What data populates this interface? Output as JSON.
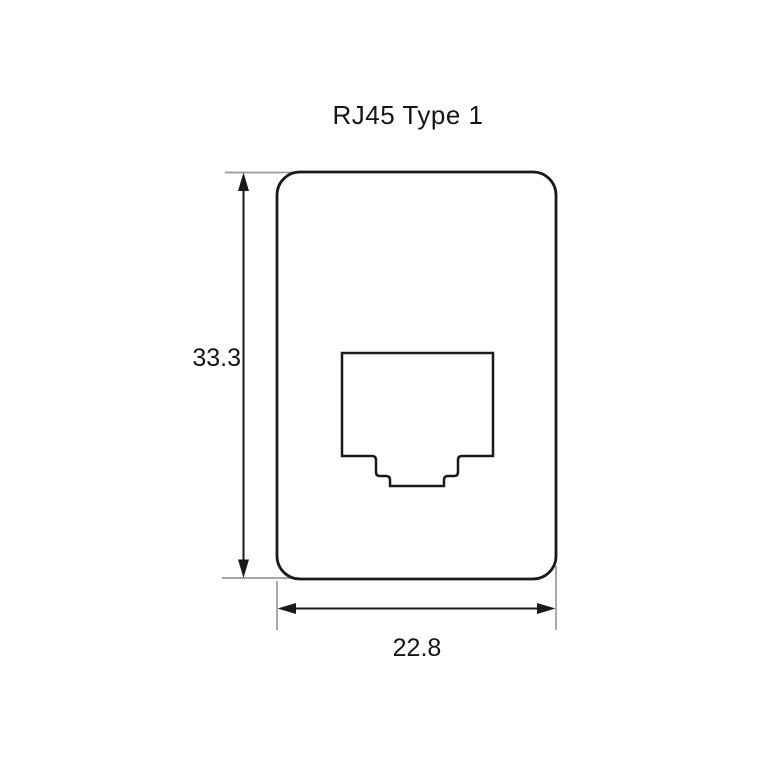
{
  "drawing": {
    "title": "RJ45 Type 1",
    "dimensions": {
      "height_value": "33.3",
      "width_value": "22.8"
    },
    "shapes": {
      "plate": "rounded-rectangle face plate outline",
      "cutout": "rj45-keystone-jack-opening"
    },
    "colors": {
      "background": "#ffffff",
      "outline": "#1a1a1a",
      "dimension_line": "#1a1a1a",
      "extension_line": "#9a9a9a",
      "text": "#161616"
    }
  }
}
